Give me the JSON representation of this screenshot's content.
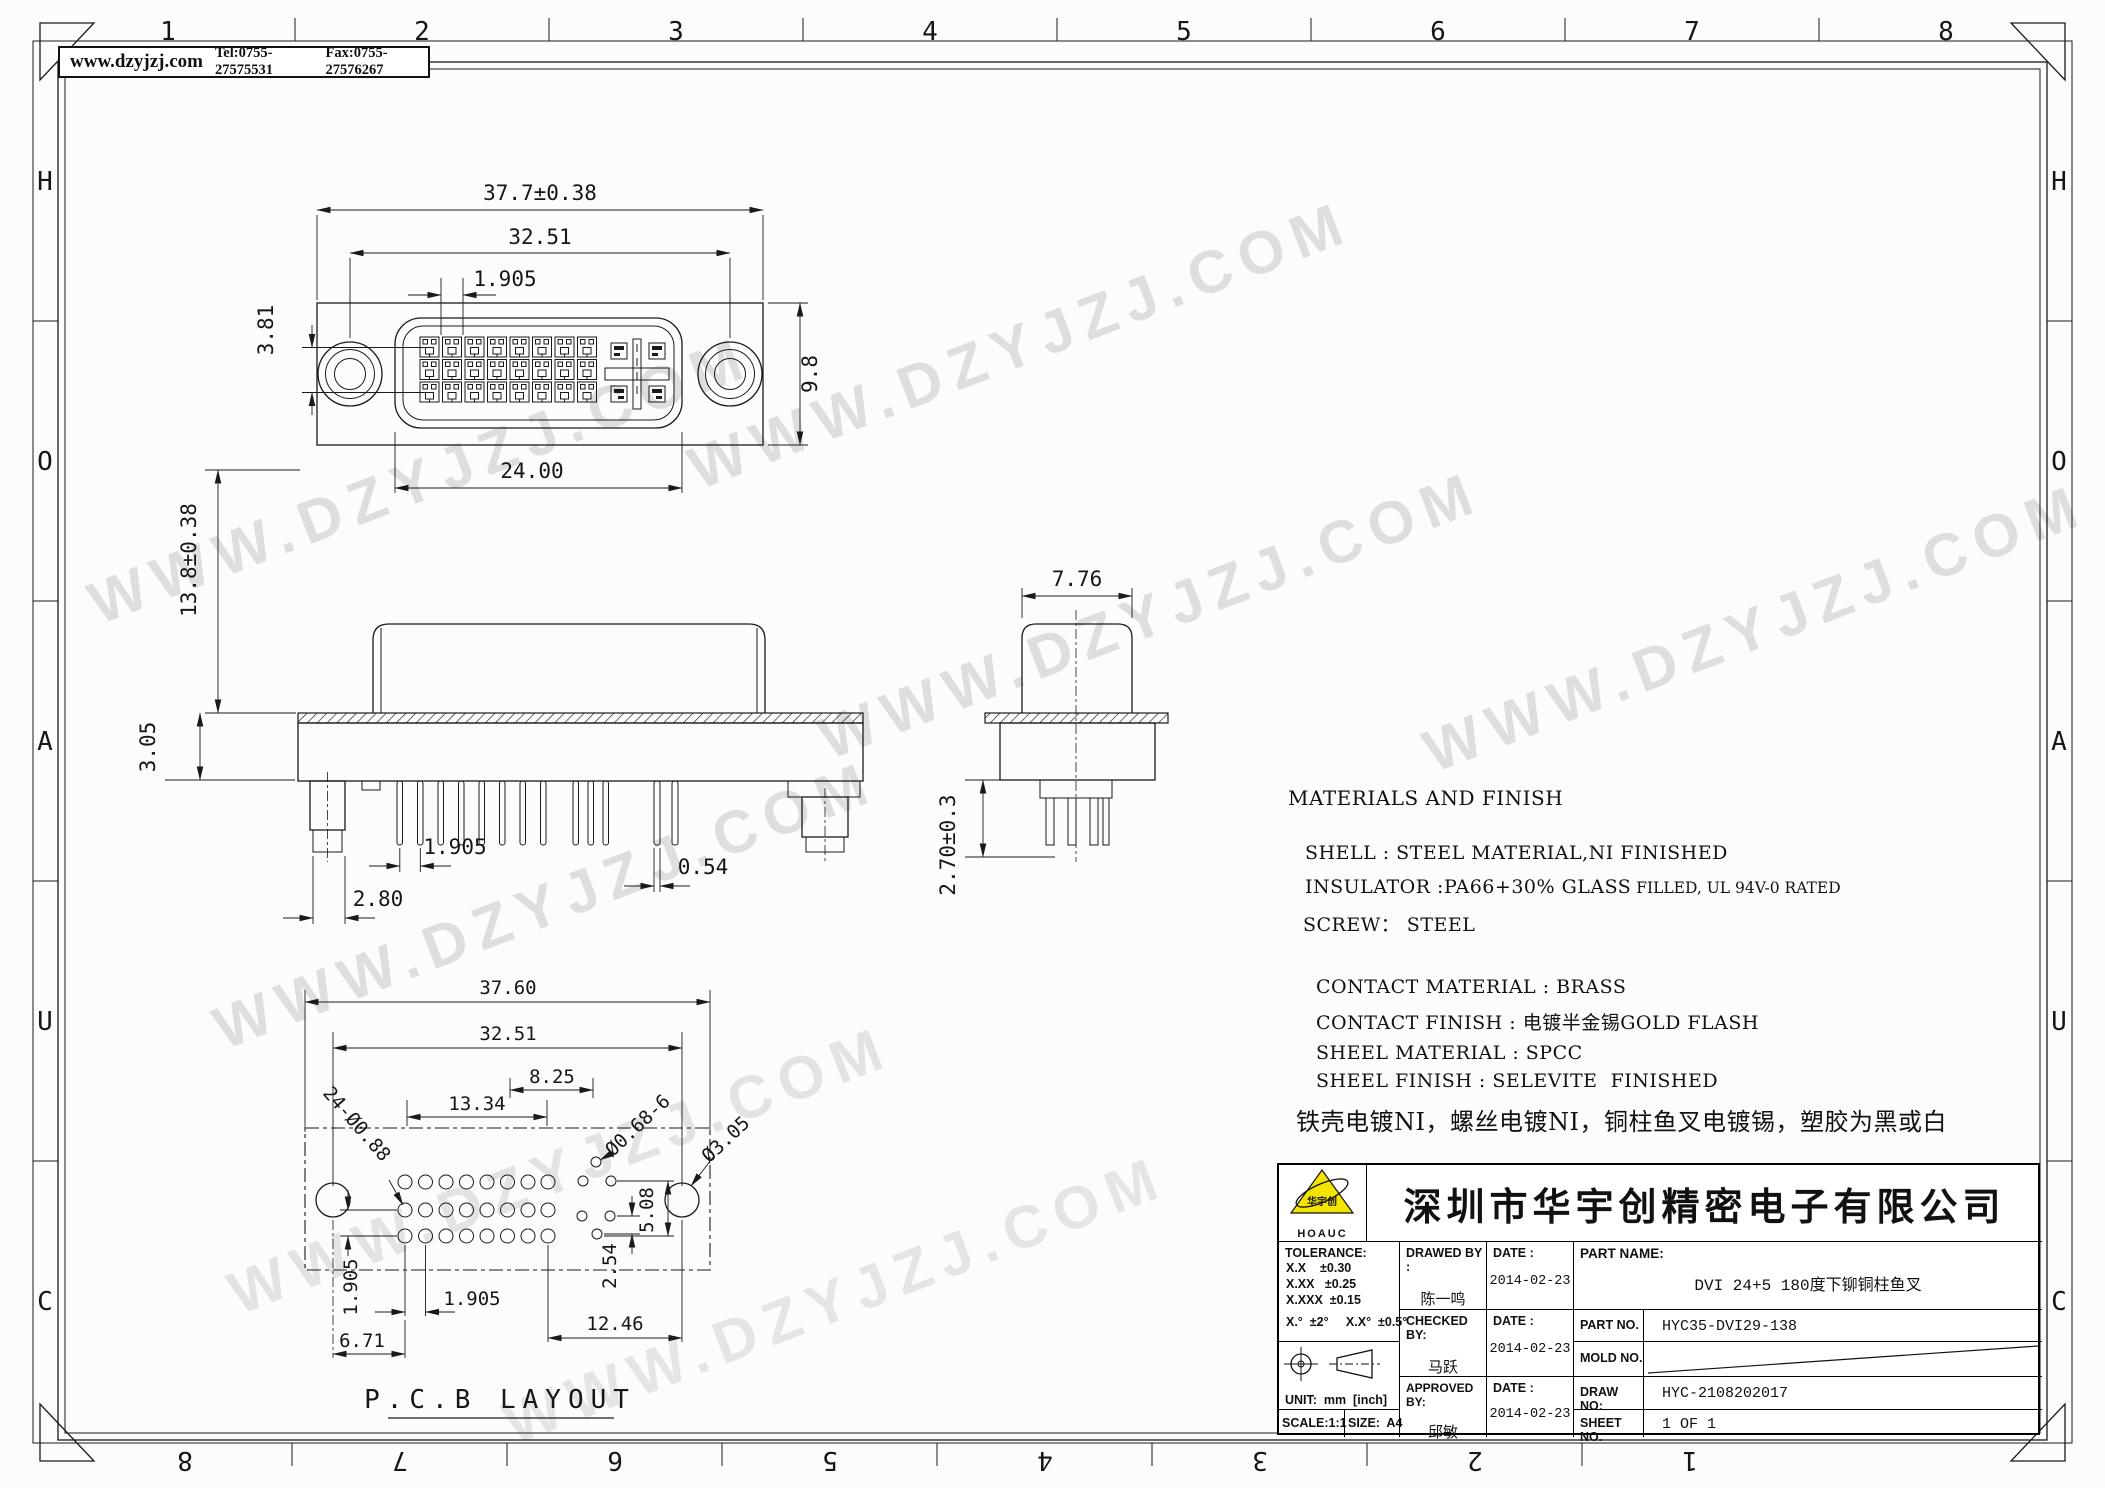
{
  "header": {
    "website": "www.dzyjzj.com",
    "tel": "Tel:0755-27575531",
    "fax": "Fax:0755-27576267"
  },
  "watermark": "WWW.DZYJZJ.COM",
  "ruler": {
    "top": [
      "1",
      "2",
      "3",
      "4",
      "5",
      "6",
      "7",
      "8"
    ],
    "bottom": [
      "8",
      "7",
      "6",
      "5",
      "4",
      "3",
      "2",
      "1"
    ],
    "left": [
      "H",
      "O",
      "A",
      "U",
      "C"
    ],
    "right": [
      "H",
      "O",
      "A",
      "U",
      "C"
    ]
  },
  "views": {
    "front": {
      "dims": {
        "overall_width": "37.7±0.38",
        "mount_span": "32.51",
        "pin_pitch": "1.905",
        "row_span": "3.81",
        "shell_height": "9.8",
        "shroud_width": "24.00"
      }
    },
    "side": {
      "dims": {
        "height": "13.8±0.38",
        "flange_height": "3.05",
        "boss_width": "2.80",
        "pin_pitch": "1.905",
        "pin_width": "0.54"
      }
    },
    "end": {
      "dims": {
        "width": "7.76",
        "pin_length": "2.70±0.3"
      }
    },
    "pcb": {
      "title": "P.C.B  LAYOUT",
      "dims": {
        "overall": "37.60",
        "mount_span": "32.51",
        "c5_width": "13.34",
        "c5_inner": "8.25",
        "signal_holes": "24-Ø0.88",
        "c5_holes": "Ø0.68-6",
        "mount_hole": "Ø3.05",
        "c5_height": "5.08",
        "c5_pitch": "2.54",
        "right_span": "12.46",
        "row_pitch": "1.905",
        "col_pitch": "1.905",
        "left_offset": "6.71"
      }
    }
  },
  "materials": {
    "title": "MATERIALS AND FINISH",
    "shell": "SHELL : STEEL MATERIAL,NI FINISHED",
    "insulator": "INSULATOR :PA66+30% GLASS",
    "insulator2": " FILLED, UL 94V-0 RATED",
    "screw": "SCREW： STEEL",
    "contact_material": "CONTACT MATERIAL : BRASS",
    "contact_finish": "CONTACT FINISH : 电镀半金锡GOLD FLASH",
    "sheel_material": "SHEEL MATERIAL : SPCC",
    "sheel_finish": "SHEEL FINISH : SELEVITE  FINISHED",
    "note_cn": "铁壳电镀NI，螺丝电镀NI，铜柱鱼叉电镀锡，塑胶为黑或白"
  },
  "title_block": {
    "logo_text": "HOAUC",
    "logo_cn": "华宇创",
    "company": "深圳市华宇创精密电子有限公司",
    "tolerance_label": "TOLERANCE:",
    "tol1": "X.X    ±0.30",
    "tol2": "X.XX   ±0.25",
    "tol3": "X.XXX  ±0.15",
    "tol_angle": "X.°  ±2°     X.X°  ±0.5°",
    "unit": "UNIT:  mm  [inch]",
    "scale": "SCALE:1:1",
    "size": "SIZE:  A4",
    "drawed_label": "DRAWED BY :",
    "drawed_name": "陈一鸣",
    "date_label1": "DATE :",
    "date1": "2014-02-23",
    "checked_label": "CHECKED BY:",
    "checked_name": "马跃",
    "date_label2": "DATE :",
    "date2": "2014-02-23",
    "approved_label": "APPROVED BY:",
    "approved_name": "邱敏",
    "date_label3": "DATE :",
    "date3": "2014-02-23",
    "part_name_label": "PART NAME:",
    "part_name": "DVI 24+5 180度下铆铜柱鱼叉",
    "part_no_label": "PART NO.",
    "part_no": "HYC35-DVI29-138",
    "mold_no_label": "MOLD NO.",
    "draw_no_label": "DRAW NO:",
    "draw_no": "HYC-2108202017",
    "sheet_no_label": "SHEET NO.",
    "sheet_no": "1 OF 1"
  }
}
